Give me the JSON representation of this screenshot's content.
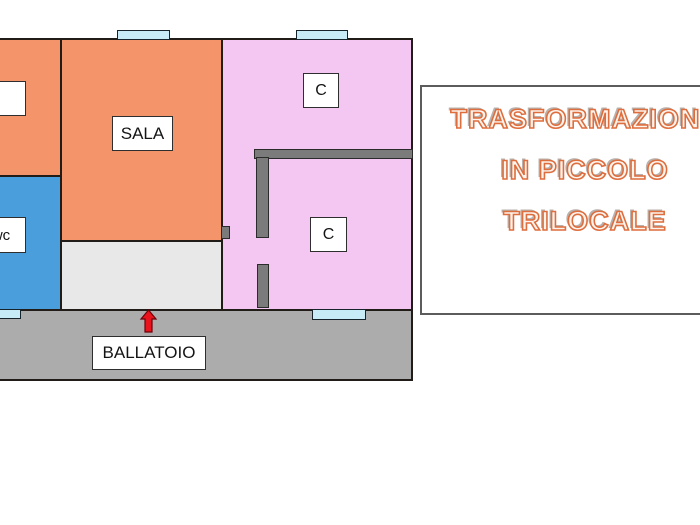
{
  "plan": {
    "labels": {
      "room_left": "",
      "wc": "wc",
      "sala": "SALA",
      "camera_top": "C",
      "camera_bottom": "C",
      "ballatoio": "BALLATOIO"
    }
  },
  "panel": {
    "line1": "TRASFORMAZIONE",
    "line2": "IN PICCOLO",
    "line3": "TRILOCALE"
  },
  "colors": {
    "room-orange": "#F4946B",
    "room-blue": "#4A9EDB",
    "room-pink": "#F3C7F1",
    "entry-gray": "#E8E8E8",
    "corridor-gray": "#ACACAC",
    "wall-gray": "#7B7B7B",
    "window-cyan": "#C7ECF7",
    "arrow-red": "#E8131C",
    "title-accent": "#DE6E3E"
  }
}
